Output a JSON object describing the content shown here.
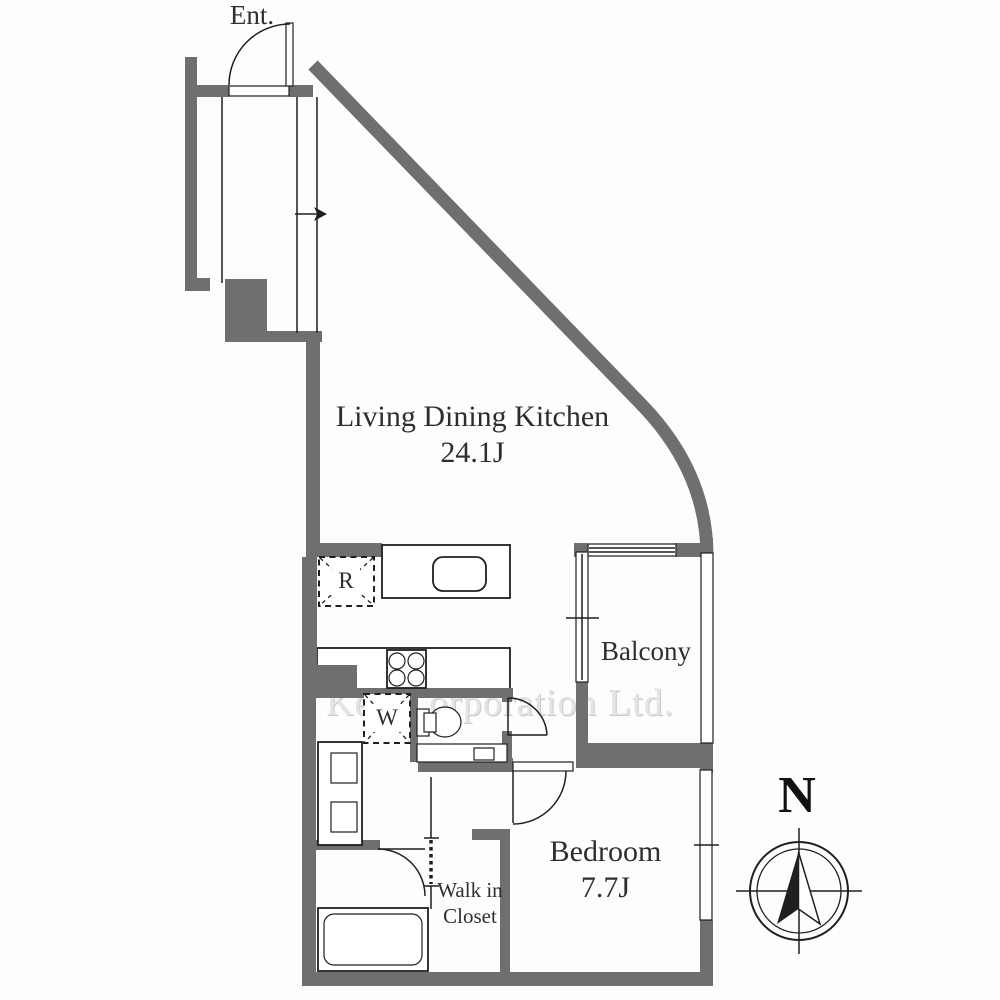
{
  "colors": {
    "wall": "#6f6f6f",
    "line": "#1f1f1f",
    "text": "#2e2e2e",
    "watermark": "#e4e4e4",
    "background": "#fdfdfc"
  },
  "labels": {
    "entrance": "Ent.",
    "ldk_name": "Living Dining Kitchen",
    "ldk_size": "24.1J",
    "balcony": "Balcony",
    "bedroom_name": "Bedroom",
    "bedroom_size": "7.7J",
    "wic_line1": "Walk in",
    "wic_line2": "Closet",
    "refrigerator_symbol": "R",
    "washing_machine_symbol": "W",
    "compass_north": "N"
  },
  "watermark": "Ken Corporation Ltd."
}
